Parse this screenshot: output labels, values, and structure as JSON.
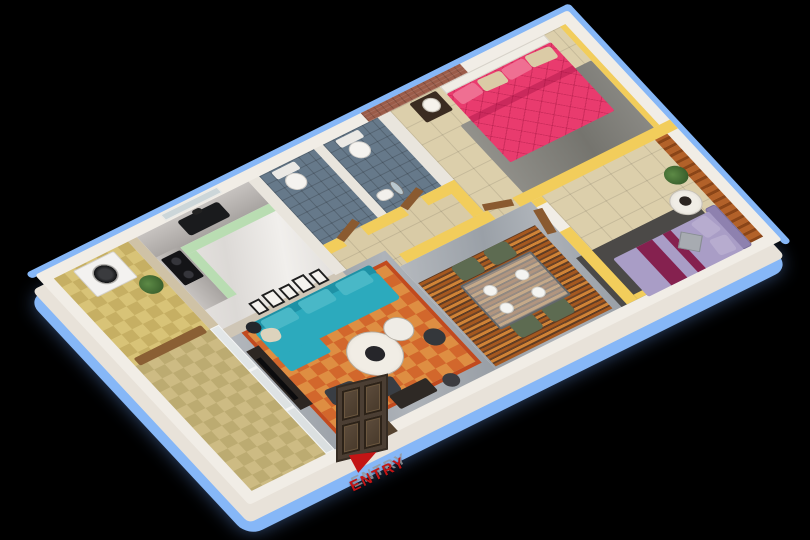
{
  "palette": {
    "background": "#000000",
    "outline_blue": "#86b7f7",
    "wall_top_white": "#f1ede6",
    "wall_front_white": "#e8e2d9",
    "partition_yellow": "#f2cd5b"
  },
  "entry": {
    "label": "ENTRY",
    "color": "#c31515"
  },
  "scene": {
    "description": "3d-isometric-apartment-floor-plan",
    "items": [
      {
        "n": "outline-rim-top",
        "x": -6,
        "y": -6,
        "w": 614,
        "h": 8,
        "bg": "var(--outline)",
        "r": "4px"
      },
      {
        "n": "outline-rim-right",
        "x": 600,
        "y": -6,
        "w": 8,
        "h": 327,
        "bg": "var(--outline)",
        "r": "4px"
      },
      {
        "n": "outer-wall-top-face",
        "x": 0,
        "y": 0,
        "w": 602,
        "h": 315,
        "bg": "var(--wallTop)",
        "r": "3px"
      },
      {
        "n": "utility-floor",
        "c": "checker",
        "x": 12,
        "y": 12,
        "w": 84,
        "h": 120,
        "v1": "#d8c377",
        "v2": "#c6af63"
      },
      {
        "n": "balcony-floor",
        "c": "checker",
        "x": 12,
        "y": 132,
        "w": 84,
        "h": 171,
        "v1": "#cdbb83",
        "v2": "#bcab71"
      },
      {
        "n": "kitchen-west-stone-wall",
        "x": 96,
        "y": 12,
        "w": 10,
        "h": 120,
        "bg": "#cfc2a6"
      },
      {
        "n": "kitchen-floor",
        "c": "marblew",
        "x": 106,
        "y": 12,
        "w": 126,
        "h": 128
      },
      {
        "n": "balcony-glass-partition",
        "c": "glass",
        "x": 96,
        "y": 132,
        "w": 10,
        "h": 171
      },
      {
        "n": "glass-frame-bar-1",
        "x": 96,
        "y": 188,
        "w": 10,
        "h": 3,
        "bg": "#f3f4f4"
      },
      {
        "n": "glass-frame-bar-2",
        "x": 96,
        "y": 242,
        "w": 10,
        "h": 3,
        "bg": "#f3f4f4"
      },
      {
        "n": "bathroom1-floor",
        "c": "tilesb",
        "x": 244,
        "y": 12,
        "w": 62,
        "h": 94,
        "v1": "#66798a"
      },
      {
        "n": "bathroom2-floor",
        "c": "tilesb",
        "x": 316,
        "y": 12,
        "w": 62,
        "h": 94,
        "v1": "#66798a"
      },
      {
        "n": "corridor-floor",
        "c": "tiles",
        "x": 244,
        "y": 106,
        "w": 192,
        "h": 56,
        "v1": "#d9cba6"
      },
      {
        "n": "master-bedroom-floor",
        "c": "tiles",
        "x": 392,
        "y": 12,
        "w": 198,
        "h": 138,
        "v1": "#dccfab"
      },
      {
        "n": "bedroom2-floor",
        "c": "tiles",
        "x": 448,
        "y": 150,
        "w": 128,
        "h": 153,
        "v1": "#dccfab"
      },
      {
        "n": "living-room-floor",
        "c": "marbleg",
        "x": 106,
        "y": 140,
        "w": 182,
        "h": 163
      },
      {
        "n": "dining-floor",
        "c": "marbleg",
        "x": 288,
        "y": 162,
        "w": 148,
        "h": 141
      },
      {
        "n": "utility-balcony-door",
        "x": 16,
        "y": 124,
        "w": 76,
        "h": 10,
        "bg": "#8a5f34",
        "r": "2px"
      },
      {
        "n": "master-rug",
        "x": 436,
        "y": 58,
        "w": 148,
        "h": 94,
        "bg": "linear-gradient(100deg,#93928c,#75746e 60%,#8a8984)",
        "r": "2px"
      },
      {
        "n": "living-rug",
        "c": "checker",
        "x": 118,
        "y": 150,
        "w": 164,
        "h": 140,
        "v1": "#d2672c",
        "v2": "#de8e42",
        "bd": "4px solid #c24a1e"
      },
      {
        "n": "dining-rug",
        "c": "rugstripes",
        "x": 290,
        "y": 186,
        "w": 132,
        "h": 114
      },
      {
        "n": "bedroom2-rug",
        "x": 430,
        "y": 236,
        "w": 132,
        "h": 67,
        "bg": "#4b4947"
      },
      {
        "n": "gallery-wall",
        "x": 106,
        "y": 138,
        "w": 134,
        "h": 12,
        "bg": "#cfc6b6"
      },
      {
        "n": "wall-kitchen-bath",
        "x": 232,
        "y": 12,
        "w": 12,
        "h": 128,
        "bg": "#e9e5dd"
      },
      {
        "n": "wall-bath-divider",
        "x": 306,
        "y": 12,
        "w": 10,
        "h": 94,
        "bg": "#e9e5dd"
      },
      {
        "n": "wall-bath-east",
        "x": 378,
        "y": 12,
        "w": 14,
        "h": 94,
        "bg": "#e9e5dd"
      },
      {
        "n": "wall-bath-front-a",
        "x": 244,
        "y": 106,
        "w": 18,
        "h": 12,
        "bg": "var(--yellow)"
      },
      {
        "n": "wall-bath-front-b",
        "x": 286,
        "y": 106,
        "w": 46,
        "h": 12,
        "bg": "var(--yellow)"
      },
      {
        "n": "wall-bath-front-c",
        "x": 354,
        "y": 106,
        "w": 38,
        "h": 12,
        "bg": "var(--yellow)"
      },
      {
        "n": "wall-master-west",
        "x": 380,
        "y": 106,
        "w": 12,
        "h": 44,
        "bg": "var(--yellow)"
      },
      {
        "n": "wall-south-a",
        "x": 296,
        "y": 150,
        "w": 100,
        "h": 12,
        "bg": "var(--yellow)"
      },
      {
        "n": "wall-south-b",
        "x": 424,
        "y": 150,
        "w": 178,
        "h": 12,
        "bg": "var(--yellow)"
      },
      {
        "n": "wall-bedroom2-west-a",
        "x": 436,
        "y": 162,
        "w": 12,
        "h": 8,
        "bg": "var(--yellow)"
      },
      {
        "n": "wall-bedroom2-west-b",
        "x": 436,
        "y": 204,
        "w": 12,
        "h": 99,
        "bg": "var(--yellow)"
      },
      {
        "n": "wall-orange-slat-accent",
        "c": "slats",
        "x": 576,
        "y": 162,
        "w": 14,
        "h": 141,
        "v1": "#b26129",
        "v2": "#8a4518"
      },
      {
        "n": "wall-brick-accent",
        "c": "brick",
        "x": 368,
        "y": 0,
        "w": 112,
        "h": 12
      },
      {
        "n": "wall-yellow-master-east",
        "x": 584,
        "y": 12,
        "w": 6,
        "h": 138,
        "bg": "var(--yellow)"
      },
      {
        "n": "wall-yellow-bedroom2-front",
        "x": 448,
        "y": 297,
        "w": 128,
        "h": 6,
        "bg": "var(--yellow)"
      },
      {
        "n": "kitchen-window",
        "x": 140,
        "y": 2,
        "w": 64,
        "h": 8,
        "bg": "#ccd6d9",
        "bd": "1px solid #eeede9"
      },
      {
        "n": "entry-door-plan",
        "x": 110,
        "y": 301,
        "w": 58,
        "h": 14,
        "bg": "#55432f"
      },
      {
        "n": "gallery-frame-1",
        "x": 144,
        "y": 126,
        "w": 12,
        "h": 16,
        "bg": "#f4f2ee",
        "bd": "2px solid #1e1e1e"
      },
      {
        "n": "gallery-frame-2",
        "x": 160,
        "y": 124,
        "w": 14,
        "h": 18,
        "bg": "#f4f2ee",
        "bd": "2px solid #1e1e1e"
      },
      {
        "n": "gallery-frame-3",
        "x": 178,
        "y": 126,
        "w": 12,
        "h": 16,
        "bg": "#f4f2ee",
        "bd": "2px solid #1e1e1e"
      },
      {
        "n": "gallery-frame-4",
        "x": 194,
        "y": 124,
        "w": 14,
        "h": 18,
        "bg": "#f4f2ee",
        "bd": "2px solid #1e1e1e"
      },
      {
        "n": "gallery-frame-5",
        "x": 212,
        "y": 126,
        "w": 12,
        "h": 16,
        "bg": "#f4f2ee",
        "bd": "2px solid #1e1e1e"
      },
      {
        "n": "bathroom1-door",
        "x": 260,
        "y": 100,
        "w": 28,
        "h": 8,
        "bg": "#8a5a30",
        "o": -22
      },
      {
        "n": "bathroom2-door",
        "x": 332,
        "y": 100,
        "w": 28,
        "h": 8,
        "bg": "#8a5a30",
        "o": -22
      },
      {
        "n": "master-bedroom-door",
        "x": 394,
        "y": 146,
        "w": 28,
        "h": 8,
        "bg": "#8a5a30",
        "o": 18
      },
      {
        "n": "bedroom2-door",
        "x": 428,
        "y": 172,
        "w": 9,
        "h": 30,
        "bg": "#8a5a30",
        "o": 12
      },
      {
        "n": "kitchen-counter-back",
        "x": 106,
        "y": 12,
        "w": 126,
        "h": 30,
        "bg": "linear-gradient(#c6c2bf,#a8a4a1)"
      },
      {
        "n": "kitchen-counter-left",
        "x": 106,
        "y": 40,
        "w": 26,
        "h": 72,
        "bg": "linear-gradient(90deg,#c6c2bf,#a8a4a1)"
      },
      {
        "n": "kitchen-cabinet-mint-back",
        "x": 132,
        "y": 42,
        "w": 100,
        "h": 10,
        "bg": "#b9ddb2"
      },
      {
        "n": "kitchen-cabinet-mint-left",
        "x": 132,
        "y": 52,
        "w": 10,
        "h": 60,
        "bg": "#b9ddb2"
      },
      {
        "n": "kitchen-sink",
        "x": 148,
        "y": 16,
        "w": 46,
        "h": 20,
        "bg": "#1a1b1d",
        "r": "3px"
      },
      {
        "n": "kitchen-faucet",
        "x": 166,
        "y": 13,
        "w": 10,
        "h": 6,
        "bg": "#222",
        "r": "3px"
      },
      {
        "n": "kitchen-cooktop",
        "c": "cooktop",
        "x": 108,
        "y": 44,
        "w": 22,
        "h": 36,
        "r": "2px"
      },
      {
        "n": "washing-machine",
        "x": 32,
        "y": 14,
        "w": 46,
        "h": 36,
        "bg": "#f3f2f0",
        "bd": "1px solid #d5d2ce",
        "r": "2px"
      },
      {
        "n": "washing-machine-door",
        "x": 43,
        "y": 20,
        "w": 24,
        "h": 24,
        "bg": "radial-gradient(circle,#3a3b3e 0 35%,#141517 60%,#8e8d8a 61%,#c9c7c4 70%)",
        "r": "50%"
      },
      {
        "n": "utility-plant",
        "x": 72,
        "y": 52,
        "w": 22,
        "h": 22,
        "bg": "radial-gradient(circle at 40% 40%,#5d8a46,#2f5224)",
        "r": "50%"
      },
      {
        "n": "toilet1-tank",
        "x": 256,
        "y": 14,
        "w": 26,
        "h": 10,
        "bg": "#ebe9e5",
        "r": "2px"
      },
      {
        "n": "toilet1-bowl",
        "x": 259,
        "y": 24,
        "w": 20,
        "h": 20,
        "bg": "#f5f3ef",
        "bd": "1px solid #cfccc7",
        "r": "50%"
      },
      {
        "n": "toilet2-tank",
        "x": 328,
        "y": 14,
        "w": 26,
        "h": 10,
        "bg": "#ebe9e5",
        "r": "2px"
      },
      {
        "n": "toilet2-bowl",
        "x": 331,
        "y": 24,
        "w": 20,
        "h": 20,
        "bg": "#f5f3ef",
        "bd": "1px solid #cfccc7",
        "r": "50%"
      },
      {
        "n": "bathroom-sink",
        "x": 320,
        "y": 82,
        "w": 16,
        "h": 12,
        "bg": "#f2f0ec",
        "bd": "1px solid #c9c6c1",
        "r": "40%"
      },
      {
        "n": "bathroom-mirror",
        "x": 338,
        "y": 78,
        "w": 8,
        "h": 18,
        "bg": "#b9c7ce",
        "bd": "1px solid #777",
        "r": "50%"
      },
      {
        "n": "tv-console",
        "x": 108,
        "y": 170,
        "w": 14,
        "h": 80,
        "bg": "#2d2723"
      },
      {
        "n": "tv-screen",
        "x": 110,
        "y": 182,
        "w": 5,
        "h": 56,
        "bg": "#0b0b0d"
      },
      {
        "n": "sofa-back",
        "x": 128,
        "y": 146,
        "w": 138,
        "h": 12,
        "bg": "#1e91a5",
        "r": "3px"
      },
      {
        "n": "sofa-seat",
        "x": 128,
        "y": 156,
        "w": 138,
        "h": 36,
        "bg": "#2caabd",
        "r": "4px"
      },
      {
        "n": "sofa-chaise",
        "x": 128,
        "y": 190,
        "w": 46,
        "h": 20,
        "bg": "#2caabd",
        "r": "3px"
      },
      {
        "n": "sofa-cushion-1",
        "x": 140,
        "y": 148,
        "w": 34,
        "h": 16,
        "bg": "#49b8c7",
        "r": "3px"
      },
      {
        "n": "sofa-cushion-2",
        "x": 182,
        "y": 148,
        "w": 34,
        "h": 16,
        "bg": "#49b8c7",
        "r": "3px"
      },
      {
        "n": "sofa-cushion-3",
        "x": 224,
        "y": 148,
        "w": 34,
        "h": 16,
        "bg": "#49b8c7",
        "r": "3px"
      },
      {
        "n": "sofa-pillow-cream",
        "x": 130,
        "y": 158,
        "w": 18,
        "h": 16,
        "bg": "#ddd3bd",
        "r": "40%",
        "o": 18
      },
      {
        "n": "coffee-table-main",
        "x": 180,
        "y": 206,
        "w": 52,
        "h": 52,
        "bg": "radial-gradient(circle,#f1ede5 60%,#ddd8cf)",
        "bd": "1px solid #b3ada3",
        "r": "50%"
      },
      {
        "n": "coffee-table-hub",
        "x": 197,
        "y": 223,
        "w": 18,
        "h": 18,
        "bg": "#26262a",
        "r": "50%"
      },
      {
        "n": "coffee-table-small",
        "x": 228,
        "y": 206,
        "w": 28,
        "h": 28,
        "bg": "#efece6",
        "bd": "1px solid #b3ada3",
        "r": "50%"
      },
      {
        "n": "side-table-dark",
        "x": 254,
        "y": 234,
        "w": 20,
        "h": 20,
        "bg": "#34373b",
        "r": "50%"
      },
      {
        "n": "ottoman-1",
        "x": 138,
        "y": 244,
        "w": 30,
        "h": 20,
        "bg": "#393d43",
        "r": "4px",
        "o": 6
      },
      {
        "n": "ottoman-2",
        "x": 172,
        "y": 258,
        "w": 30,
        "h": 20,
        "bg": "#393d43",
        "r": "4px",
        "o": 6
      },
      {
        "n": "floor-lamp",
        "x": 124,
        "y": 144,
        "w": 14,
        "h": 14,
        "bg": "#23262b",
        "r": "50%"
      },
      {
        "n": "entry-bench",
        "x": 186,
        "y": 278,
        "w": 42,
        "h": 18,
        "bg": "#2e2925",
        "r": "2px"
      },
      {
        "n": "entry-stool",
        "x": 238,
        "y": 284,
        "w": 16,
        "h": 16,
        "bg": "#3c3c40",
        "r": "50%"
      },
      {
        "n": "dining-chair-1",
        "x": 326,
        "y": 186,
        "w": 26,
        "h": 20,
        "bg": "#5d6b51",
        "r": "4px"
      },
      {
        "n": "dining-chair-2",
        "x": 362,
        "y": 186,
        "w": 26,
        "h": 20,
        "bg": "#5d6b51",
        "r": "4px"
      },
      {
        "n": "dining-chair-3",
        "x": 330,
        "y": 266,
        "w": 26,
        "h": 20,
        "bg": "#5d6b51",
        "r": "4px"
      },
      {
        "n": "dining-chair-4",
        "x": 366,
        "y": 266,
        "w": 26,
        "h": 20,
        "bg": "#5d6b51",
        "r": "4px"
      },
      {
        "n": "dining-table-glass",
        "x": 320,
        "y": 208,
        "w": 80,
        "h": 60,
        "bg": "rgba(188,200,205,.55)",
        "bd": "2px solid #62676b",
        "r": "2px"
      },
      {
        "n": "plate-1",
        "x": 334,
        "y": 220,
        "w": 13,
        "h": 13,
        "bg": "#f4f4f1",
        "bd": "1px solid #d0d0cc",
        "r": "50%"
      },
      {
        "n": "plate-2",
        "x": 370,
        "y": 220,
        "w": 13,
        "h": 13,
        "bg": "#f4f4f1",
        "bd": "1px solid #d0d0cc",
        "r": "50%"
      },
      {
        "n": "plate-3",
        "x": 334,
        "y": 244,
        "w": 13,
        "h": 13,
        "bg": "#f4f4f1",
        "bd": "1px solid #d0d0cc",
        "r": "50%"
      },
      {
        "n": "plate-4",
        "x": 370,
        "y": 244,
        "w": 13,
        "h": 13,
        "bg": "#f4f4f1",
        "bd": "1px solid #d0d0cc",
        "r": "50%"
      },
      {
        "n": "master-headboard",
        "x": 448,
        "y": 12,
        "w": 118,
        "h": 10,
        "bg": "#f0ede5",
        "bd": "1px solid #d6d2ca"
      },
      {
        "n": "master-bed-duvet",
        "c": "quilt",
        "x": 448,
        "y": 22,
        "w": 118,
        "h": 94,
        "r": "2px"
      },
      {
        "n": "master-bed-fold",
        "x": 448,
        "y": 54,
        "w": 118,
        "h": 7,
        "bg": "rgba(150,10,60,.35)"
      },
      {
        "n": "master-pillow-1",
        "x": 452,
        "y": 24,
        "w": 26,
        "h": 15,
        "bg": "#ef6f92",
        "r": "3px",
        "o": -4
      },
      {
        "n": "master-pillow-2",
        "x": 480,
        "y": 24,
        "w": 26,
        "h": 15,
        "bg": "#dbcba6",
        "r": "3px",
        "o": 3
      },
      {
        "n": "master-pillow-3",
        "x": 507,
        "y": 24,
        "w": 26,
        "h": 15,
        "bg": "#ef6f92",
        "r": "3px",
        "o": -2
      },
      {
        "n": "master-pillow-4",
        "x": 534,
        "y": 24,
        "w": 28,
        "h": 15,
        "bg": "#dbcba6",
        "r": "3px",
        "o": 4
      },
      {
        "n": "nightstand",
        "x": 412,
        "y": 14,
        "w": 30,
        "h": 26,
        "bg": "#3b2c21",
        "r": "2px"
      },
      {
        "n": "table-lamp",
        "x": 420,
        "y": 17,
        "w": 17,
        "h": 17,
        "bg": "radial-gradient(circle,#f6f3ec 55%,#d9d4c9)",
        "bd": "1px solid #bdb8ae",
        "r": "50%"
      },
      {
        "n": "bedroom2-headboard",
        "x": 564,
        "y": 250,
        "w": 12,
        "h": 56,
        "bg": "#8e81af",
        "bd": "1px solid #7a6d9c",
        "r": "3px"
      },
      {
        "n": "bedroom2-bed",
        "x": 458,
        "y": 254,
        "w": 108,
        "h": 52,
        "bg": "#a99dc6",
        "r": "2px"
      },
      {
        "n": "bedroom2-runner-1",
        "x": 484,
        "y": 254,
        "w": 18,
        "h": 52,
        "bg": "#85214f"
      },
      {
        "n": "bedroom2-runner-2",
        "x": 514,
        "y": 254,
        "w": 9,
        "h": 52,
        "bg": "#85214f"
      },
      {
        "n": "bedroom2-pillow-1",
        "x": 544,
        "y": 256,
        "w": 18,
        "h": 22,
        "bg": "#b7accf",
        "r": "3px",
        "o": -8
      },
      {
        "n": "bedroom2-pillow-2",
        "x": 544,
        "y": 282,
        "w": 18,
        "h": 20,
        "bg": "#b7accf",
        "r": "3px",
        "o": 6
      },
      {
        "n": "bedroom2-diamond-cushion",
        "x": 520,
        "y": 264,
        "w": 20,
        "h": 20,
        "bg": "#a7abb1",
        "bd": "1px solid #878c93",
        "o": 45
      },
      {
        "n": "bedroom2-side-table",
        "x": 540,
        "y": 220,
        "w": 30,
        "h": 30,
        "bg": "radial-gradient(circle,#f0ede6 55%,#dbd6cd)",
        "bd": "1px solid #c6c1b8",
        "r": "50%"
      },
      {
        "n": "bedroom2-vase",
        "x": 550,
        "y": 228,
        "w": 11,
        "h": 11,
        "bg": "#2b2521",
        "r": "50%"
      },
      {
        "n": "bedroom2-plant",
        "x": 556,
        "y": 194,
        "w": 22,
        "h": 22,
        "bg": "radial-gradient(circle at 40% 40%,#5d8a46,#2c4f22)",
        "r": "50%"
      }
    ]
  }
}
